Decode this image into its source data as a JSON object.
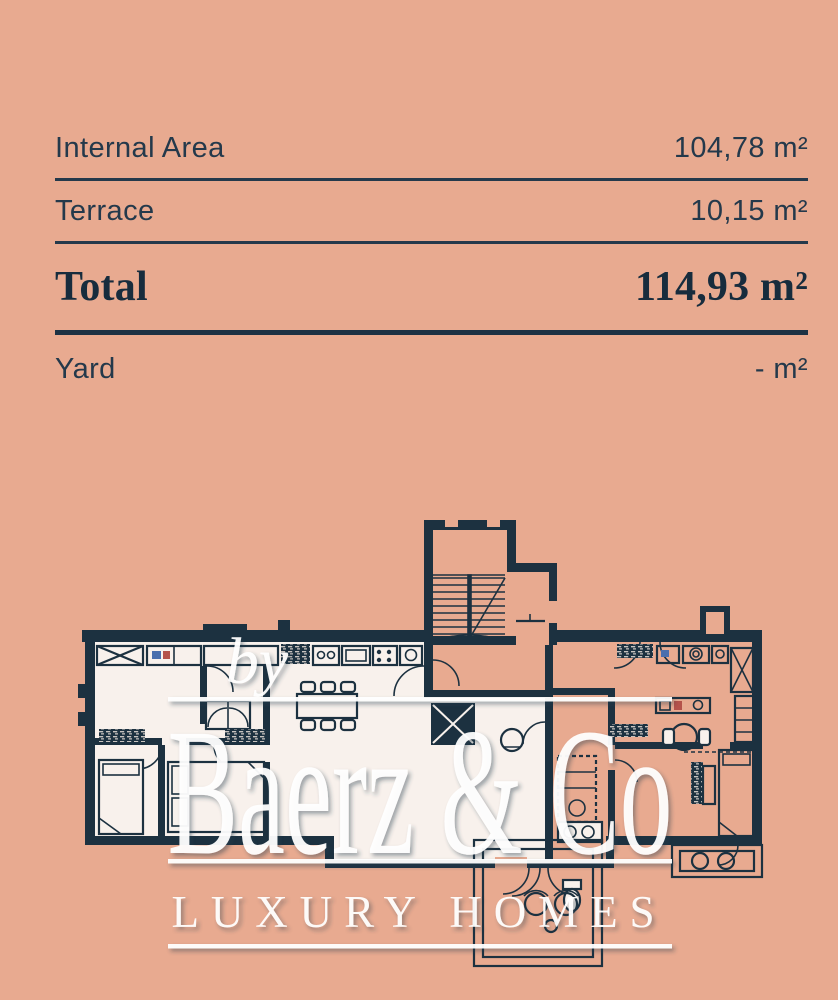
{
  "colors": {
    "background": "#e8aa90",
    "ink": "#24394b",
    "plan_wall": "#1c3140",
    "unit_floor": "#f8f1ec",
    "watermark": "#ffffff"
  },
  "area_table": {
    "rows": [
      {
        "label": "Internal Area",
        "value": "104,78 m²"
      },
      {
        "label": "Terrace",
        "value": "10,15 m²"
      },
      {
        "label": "Total",
        "value": "114,93 m²"
      },
      {
        "label": "Yard",
        "value": "- m²"
      }
    ]
  },
  "watermark": {
    "prefix": "by",
    "brand": "Baerz & Co",
    "tagline": "LUXURY HOMES"
  }
}
